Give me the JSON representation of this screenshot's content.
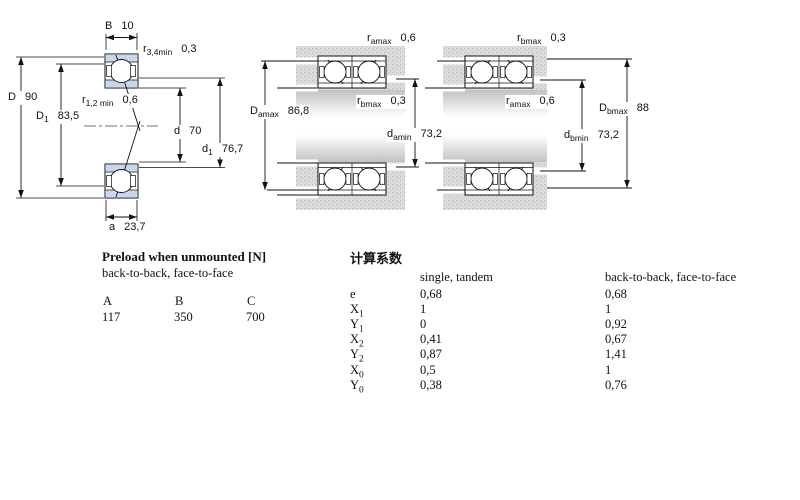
{
  "dims": {
    "B": {
      "base": "B",
      "sub": "",
      "value": "10"
    },
    "r34": {
      "base": "r",
      "sub": "3,4min",
      "value": "0,3"
    },
    "D": {
      "base": "D",
      "sub": "",
      "value": "90"
    },
    "D1": {
      "base": "D",
      "sub": "1",
      "value": "83,5"
    },
    "r12": {
      "base": "r",
      "sub": "1,2 min",
      "value": "0,6"
    },
    "d": {
      "base": "d",
      "sub": "",
      "value": "70"
    },
    "d1": {
      "base": "d",
      "sub": "1",
      "value": "76,7"
    },
    "a": {
      "base": "a",
      "sub": "",
      "value": "23,7"
    },
    "ramax_m": {
      "base": "r",
      "sub": "amax",
      "value": "0,6"
    },
    "rbmax_m": {
      "base": "r",
      "sub": "bmax",
      "value": "0,3"
    },
    "Damax": {
      "base": "D",
      "sub": "amax",
      "value": "86,8"
    },
    "damin": {
      "base": "d",
      "sub": "amin",
      "value": "73,2"
    },
    "rbmax_r": {
      "base": "r",
      "sub": "bmax",
      "value": "0,3"
    },
    "ramax_r": {
      "base": "r",
      "sub": "amax",
      "value": "0,6"
    },
    "Dbmax": {
      "base": "D",
      "sub": "bmax",
      "value": "88"
    },
    "dbmin": {
      "base": "d",
      "sub": "bmin",
      "value": "73,2"
    }
  },
  "preload_table": {
    "title": "Preload when unmounted [N]",
    "subtitle": "back-to-back, face-to-face",
    "columns": [
      "A",
      "B",
      "C"
    ],
    "values": [
      "117",
      "350",
      "700"
    ]
  },
  "factors_table": {
    "title": "计算系数",
    "col1_header": "single, tandem",
    "col2_header": "back-to-back, face-to-face",
    "rows": [
      {
        "base": "e",
        "sub": "",
        "v1": "0,68",
        "v2": "0,68"
      },
      {
        "base": "X",
        "sub": "1",
        "v1": "1",
        "v2": "1"
      },
      {
        "base": "Y",
        "sub": "1",
        "v1": "0",
        "v2": "0,92"
      },
      {
        "base": "X",
        "sub": "2",
        "v1": "0,41",
        "v2": "0,67"
      },
      {
        "base": "Y",
        "sub": "2",
        "v1": "0,87",
        "v2": "1,41"
      },
      {
        "base": "X",
        "sub": "0",
        "v1": "0,5",
        "v2": "1"
      },
      {
        "base": "Y",
        "sub": "0",
        "v1": "0,38",
        "v2": "0,76"
      }
    ]
  },
  "colors": {
    "bearing_blue": "#cdd9ec",
    "steel_gray": "#dcdcdc",
    "line": "#111111"
  }
}
